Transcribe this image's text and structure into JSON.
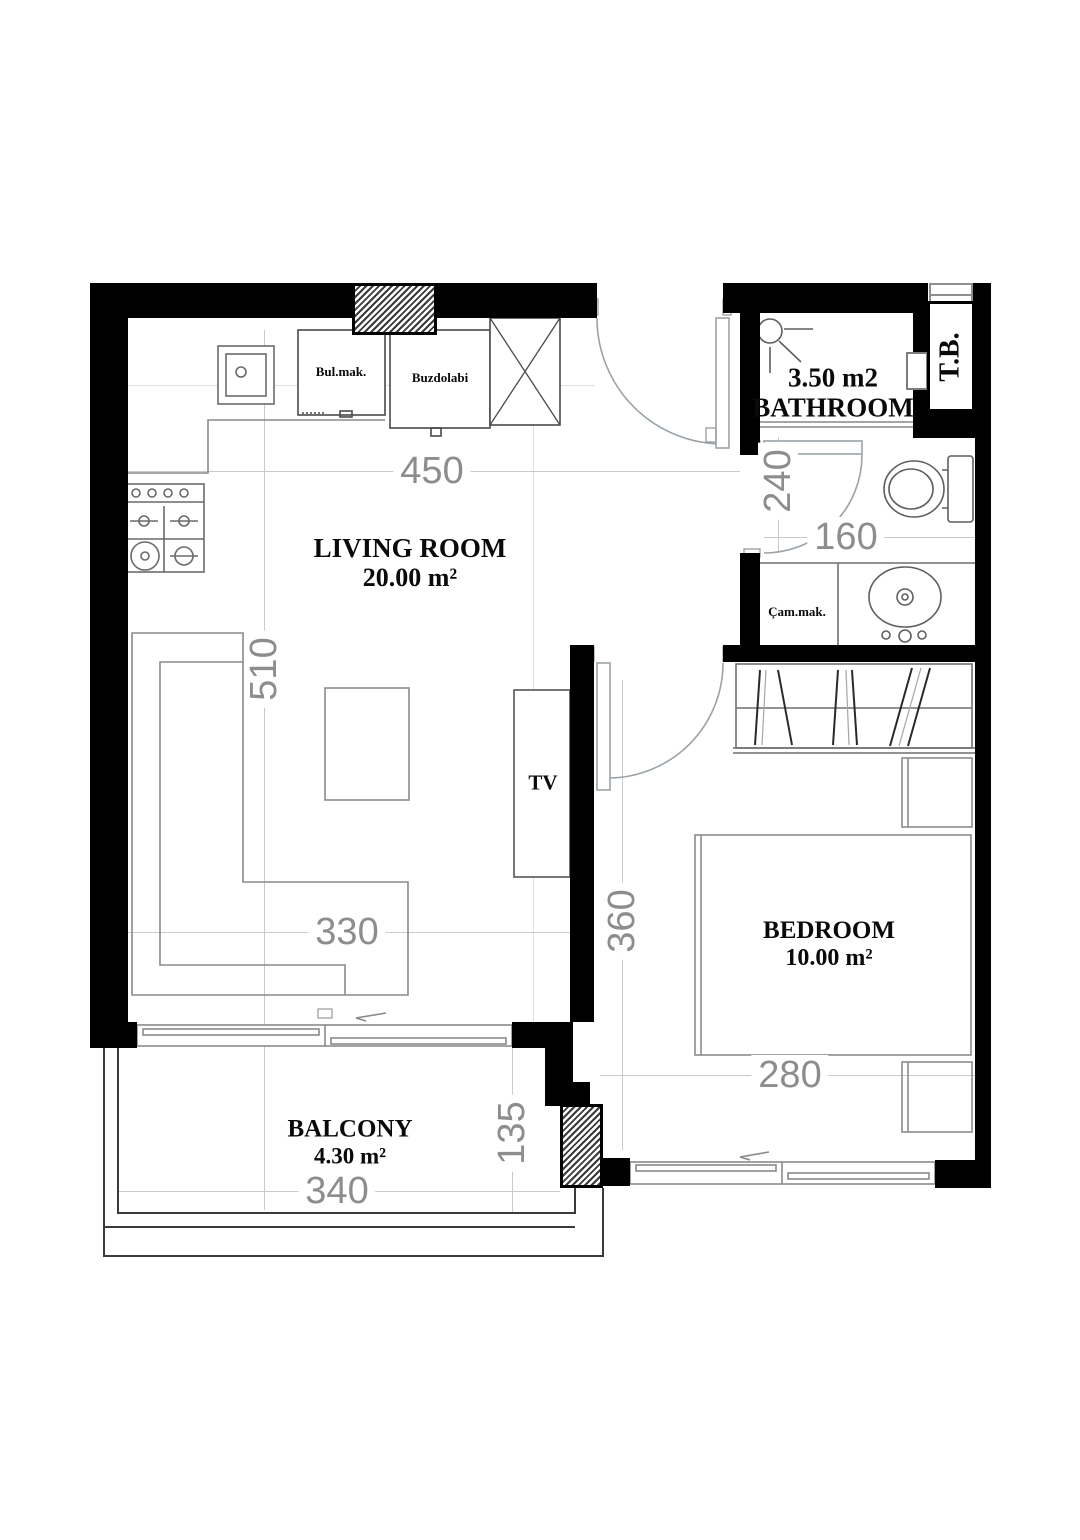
{
  "plan": {
    "rooms": {
      "living": {
        "name": "LIVING ROOM",
        "area": "20.00 m²"
      },
      "bedroom": {
        "name": "BEDROOM",
        "area": "10.00 m²"
      },
      "bathroom": {
        "area": "3.50 m2",
        "name": "BATHROOM"
      },
      "balcony": {
        "name": "BALCONY",
        "area": "4.30 m²"
      }
    },
    "fixtures": {
      "tv": "TV",
      "shaft": "T.B.",
      "dishwasher": "Bul.mak.",
      "fridge": "Buzdolabi",
      "washer": "Çam.mak."
    },
    "dimensions": {
      "living_width": "450",
      "living_depth": "510",
      "sofa_span": "330",
      "hall_depth": "240",
      "hall_width": "160",
      "bedroom_depth": "360",
      "bedroom_width": "280",
      "balcony_width": "340",
      "balcony_depth": "135"
    }
  }
}
